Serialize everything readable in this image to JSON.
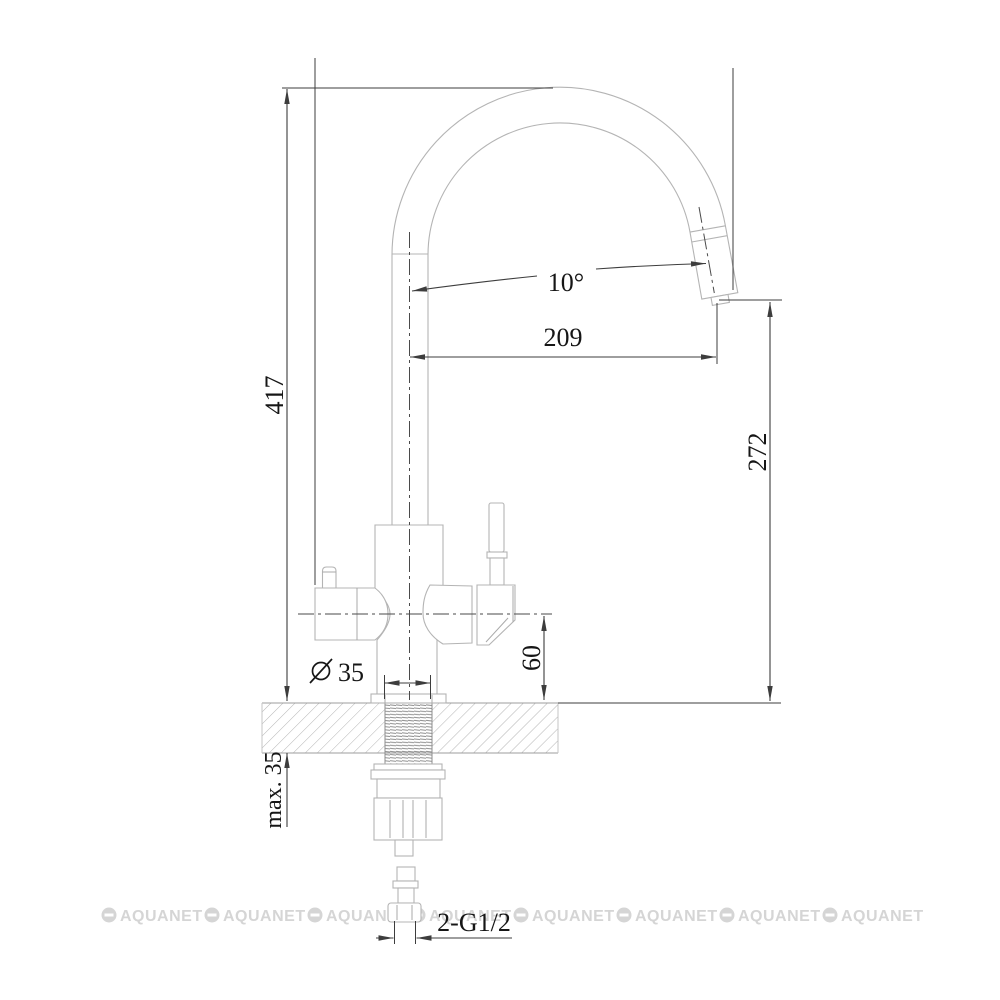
{
  "drawing": {
    "labels": {
      "overall_height": "417",
      "spout_reach": "209",
      "outlet_height": "272",
      "body_height_above_deck": "60",
      "spout_angle": "10°",
      "mounting_hole_symbol": "⌀",
      "mounting_hole_value": "35",
      "countertop_thickness": "max. 35",
      "hose_connection": "2-G1/2"
    },
    "watermark": {
      "text": "AQUANET",
      "count": 8
    },
    "colors": {
      "background": "#ffffff",
      "outline": "#b4b4b4",
      "dimension_lines": "#3d3d3d",
      "label_text": "#161616",
      "watermark": "#d5d5d5",
      "hatch": "#b4b4b4",
      "thread": "#8e8e8e"
    },
    "icons": {
      "diameter_symbol": "circle-with-slash",
      "watermark_logo": "circle-with-dash"
    }
  }
}
